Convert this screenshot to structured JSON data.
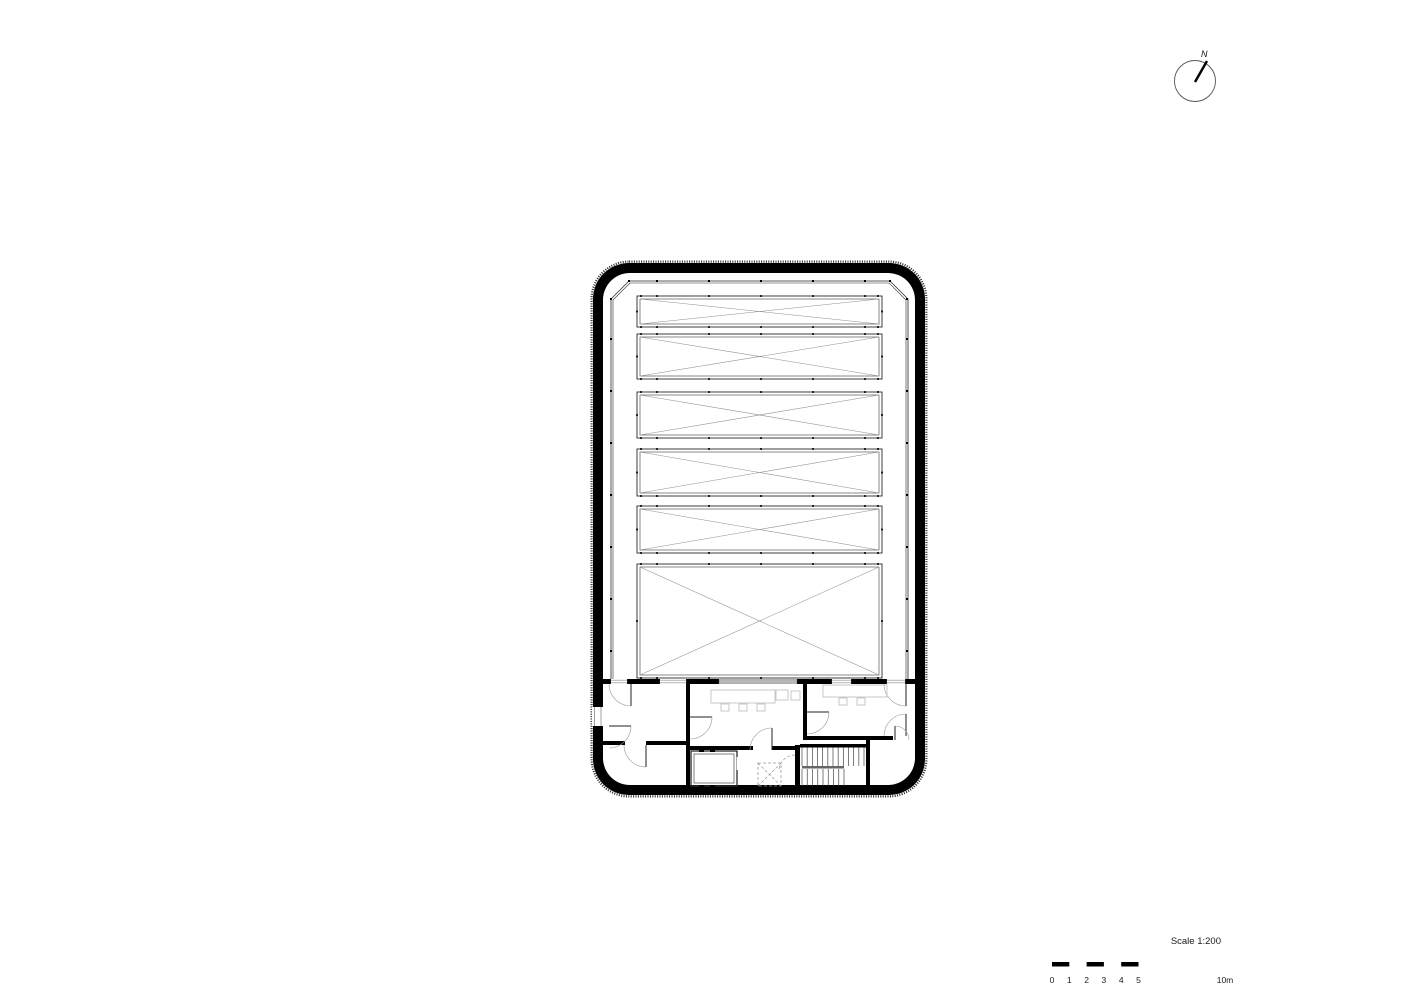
{
  "page": {
    "background": "#ffffff",
    "drawing_type": "architectural floor plan"
  },
  "north_arrow": {
    "label": "N"
  },
  "scale_bar": {
    "title": "Scale 1:200",
    "tick_labels": [
      "0",
      "1",
      "2",
      "3",
      "4",
      "5",
      "10m"
    ],
    "units_m": [
      0,
      1,
      2,
      3,
      4,
      5,
      10
    ],
    "bar": {
      "x": 1052,
      "y": 962,
      "unit_px": 17.3,
      "total_m": 10,
      "h": 4.5
    },
    "black_segments_m": [
      [
        0,
        1
      ],
      [
        2,
        3
      ],
      [
        4,
        5
      ]
    ]
  },
  "plan": {
    "colors": {
      "wall": "#000000",
      "line": "#2b2b2b",
      "brace": "#8f8f8f",
      "window": "#8a8a8a",
      "arc": "#9a9a9a",
      "furniture": "#c2c2c2",
      "glazing_fill": "#b9b9b9",
      "rail": "#666666"
    },
    "outer_wall": {
      "x": 593,
      "y": 263,
      "w": 332,
      "h": 532,
      "rx": 36,
      "thickness": 10,
      "inner_rx": 27
    },
    "left_wall_window": {
      "x": 592,
      "y": 707,
      "w": 12,
      "h": 19
    },
    "boundary": {
      "outer_pts": [
        [
          611,
          679
        ],
        [
          611,
          299
        ],
        [
          629,
          281
        ],
        [
          890,
          281
        ],
        [
          908,
          299
        ],
        [
          908,
          679
        ]
      ],
      "inner_pts": [
        [
          613,
          679
        ],
        [
          613,
          300
        ],
        [
          630,
          283
        ],
        [
          889,
          283
        ],
        [
          906,
          300
        ],
        [
          906,
          679
        ]
      ],
      "dots_top_x": [
        629,
        657,
        709,
        761,
        813,
        865,
        890
      ],
      "dots_side_y": [
        299,
        339,
        391,
        443,
        495,
        547,
        599,
        651
      ]
    },
    "skylight": {
      "x": 637,
      "w": 245,
      "inset": 3,
      "bays": [
        [
          296,
          31
        ],
        [
          334,
          45
        ],
        [
          392,
          46
        ],
        [
          449,
          47
        ],
        [
          506,
          47
        ],
        [
          564,
          114
        ]
      ],
      "edge_dots_x": [
        641,
        657,
        709,
        761,
        813,
        865,
        878
      ]
    },
    "front_wall": {
      "y": 679,
      "h": 5,
      "x1": 603,
      "x2": 915,
      "black_segments": [
        [
          603,
          610
        ],
        [
          628,
          659
        ],
        [
          687,
          719
        ],
        [
          797,
          831
        ],
        [
          852,
          886
        ],
        [
          906,
          915
        ]
      ],
      "window_segments": [
        [
          610,
          628
        ],
        [
          659,
          687
        ],
        [
          831,
          852
        ],
        [
          886,
          906
        ]
      ],
      "glazed_segment": [
        719,
        797
      ]
    },
    "walls": [
      [
        686,
        684,
        4,
        103
      ],
      [
        603,
        741,
        22,
        4
      ],
      [
        646,
        741,
        40,
        4
      ],
      [
        803,
        684,
        4,
        54
      ],
      [
        803,
        736,
        90,
        4
      ],
      [
        866,
        740,
        4,
        47
      ],
      [
        795,
        745,
        5,
        42
      ],
      [
        800,
        744,
        66,
        3.5
      ],
      [
        690,
        746,
        63,
        4
      ],
      [
        772,
        746,
        23,
        4
      ]
    ],
    "service_room": {
      "outer": [
        691,
        751,
        46,
        35
      ],
      "inner": [
        694,
        754,
        40,
        29
      ],
      "ticks": [
        [
          699,
          749.5,
          5,
          2.5
        ],
        [
          710,
          749.5,
          5,
          2.5
        ],
        [
          699,
          785,
          5,
          2.5
        ],
        [
          710,
          785,
          5,
          2.5
        ]
      ],
      "door_gap": [
        735,
        757,
        4,
        13
      ]
    },
    "elevator_shaft": {
      "rect": [
        758,
        763,
        23,
        23
      ],
      "dash": "3 2"
    },
    "stairs": {
      "x": 802,
      "upper_x2": 864,
      "lower_x2": 844,
      "top": 747.5,
      "mid": 766,
      "bot": 786,
      "upper_treads": 13,
      "lower_treads": 9,
      "rail": [
        802,
        766,
        42,
        2.5
      ]
    },
    "doors": [
      {
        "r": 22,
        "leaf": [
          631,
          684,
          631,
          706
        ],
        "a": [
          631,
          706,
          609,
          684,
          1
        ]
      },
      {
        "r": 22,
        "leaf": [
          609,
          726,
          631,
          726
        ],
        "a": [
          631,
          726,
          609,
          748,
          1
        ]
      },
      {
        "r": 22,
        "leaf": [
          646,
          745,
          646,
          767
        ],
        "a": [
          646,
          767,
          624,
          745,
          1
        ]
      },
      {
        "r": 22,
        "leaf": [
          690,
          717,
          712,
          717
        ],
        "a": [
          712,
          717,
          690,
          739,
          1
        ]
      },
      {
        "r": 22,
        "leaf": [
          807,
          712,
          829,
          712
        ],
        "a": [
          829,
          712,
          807,
          734,
          1
        ]
      },
      {
        "r": 22,
        "leaf": [
          906,
          714,
          906,
          736
        ],
        "a": [
          884,
          736,
          906,
          714,
          1
        ]
      },
      {
        "r": 22,
        "leaf": [
          906,
          684,
          906,
          706
        ],
        "a": [
          884,
          684,
          906,
          706,
          0
        ]
      },
      {
        "r": 14,
        "leaf": [
          895,
          740,
          895,
          726
        ],
        "a": [
          895,
          726,
          909,
          740,
          1
        ]
      },
      {
        "r": 22,
        "leaf": [
          772,
          750,
          772,
          728
        ],
        "a": [
          772,
          728,
          750,
          750,
          0
        ]
      }
    ],
    "dashed_arc": {
      "r": 16,
      "a": [
        795,
        755,
        779,
        771,
        0
      ]
    },
    "furniture": [
      [
        711,
        690,
        64,
        13
      ],
      [
        721,
        704,
        8,
        7
      ],
      [
        739,
        704,
        8,
        7
      ],
      [
        757,
        704,
        8,
        7
      ],
      [
        776,
        690,
        12,
        10
      ],
      [
        791,
        691,
        9,
        9
      ],
      [
        823,
        685,
        64,
        12
      ],
      [
        839,
        698,
        8,
        7
      ],
      [
        857,
        698,
        8,
        7
      ]
    ]
  }
}
